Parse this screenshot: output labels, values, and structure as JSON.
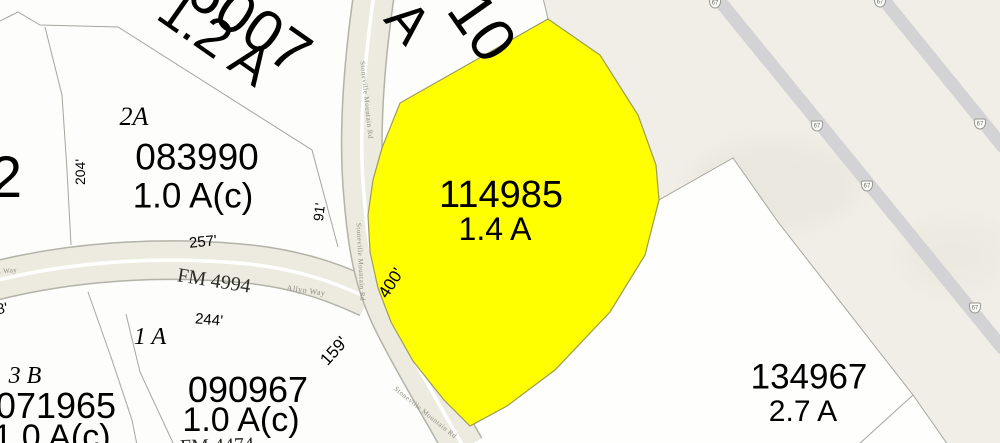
{
  "map": {
    "parcels": {
      "p086007": {
        "number": "086007",
        "acreage": "1.2 A"
      },
      "top_fragment": {
        "number": "'10",
        "acreage": "A"
      },
      "left_fragment": {
        "number": "2"
      },
      "p083990": {
        "lot": "2A",
        "number": "083990",
        "acreage": "1.0 A(c)"
      },
      "p114985": {
        "number": "114985",
        "acreage": "1.4 A"
      },
      "p134967": {
        "number": "134967",
        "acreage": "2.7 A"
      },
      "p090967": {
        "number": "090967",
        "acreage": "1.0 A(c)"
      },
      "p071965": {
        "lot": "3 B",
        "number": "071965",
        "acreage": "1.0 A(c)"
      },
      "lot_1a": "1 A"
    },
    "roads": {
      "fm4994": "FM 4994",
      "allyn_way": "Allyn Way",
      "stoneville": "Stoneville Mountain Rd",
      "fm_fragment": "FM 4474"
    },
    "measurements": {
      "m204": "204'",
      "m91": "91'",
      "m257": "257'",
      "m244": "244'",
      "m400": "400'",
      "m159": "159'",
      "m8": "8'"
    },
    "highway": {
      "shield": "67"
    },
    "colors": {
      "highlight_yellow": "#ffff00",
      "background_cream": "#f0eee6",
      "parcel_white": "#fdfdfb",
      "road_fill": "#edebe0",
      "highway_gray": "#d3d3d5",
      "boundary_gray": "#a6a69e"
    }
  }
}
